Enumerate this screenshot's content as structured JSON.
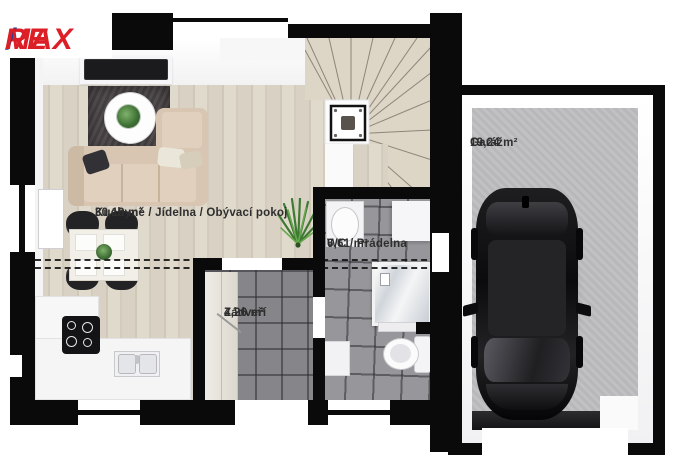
{
  "brand": {
    "re": "RE",
    "slash": "/",
    "max": "MAX",
    "color_red": "#DC1F26",
    "color_blue": "#1F4396"
  },
  "rooms": {
    "living": {
      "name": "Kuchyně / Jídelna / Obývací pokoj",
      "area": "30,19 m²"
    },
    "wc": {
      "name": "WC / Prádelna",
      "area": "6,61 m²"
    },
    "hall": {
      "name": "Zádveří",
      "area": "4,26 m²"
    },
    "garage": {
      "name": "Garáž",
      "area": "19,24 m²"
    }
  },
  "palette": {
    "wall_black": "#0a0a0a",
    "wood_floor": "#d8d1c3",
    "tile_wc": "#97979b",
    "tile_hall": "#85858a",
    "garage_floor": "#bdbdbf",
    "label_text": "#2e2e2e",
    "car_body": "#121214"
  }
}
